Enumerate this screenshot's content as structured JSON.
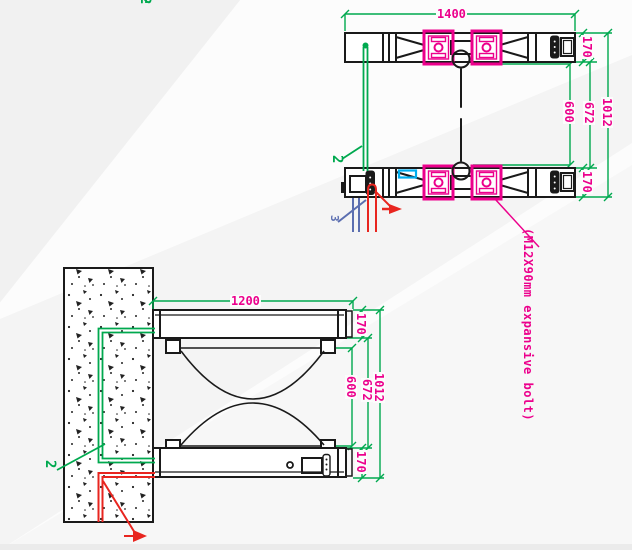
{
  "colors": {
    "green": "#00A94F",
    "magenta": "#EC008C",
    "red": "#E8251F",
    "blue": "#5B6EB0",
    "cyan": "#00AEEF",
    "ink": "#1A1A1A",
    "paper": "#FCFCFC"
  },
  "annotation": {
    "bolt_note": "(M12X90mm expansive bolt)",
    "edge_callout": "2"
  },
  "plan_view": {
    "dims": {
      "overall_width": "1400",
      "rail_top": "170",
      "rail_bottom": "170",
      "inner_span": "600",
      "between_rails": "672",
      "overall_depth": "1012"
    },
    "callouts": {
      "item2": "2",
      "item3": "3"
    }
  },
  "side_view": {
    "dims": {
      "overall_width": "1200",
      "cab_top": "170",
      "inner_span": "600",
      "between_cabs": "672",
      "overall_height": "1012",
      "cab_bottom": "170"
    },
    "callouts": {
      "item2": "2"
    }
  }
}
